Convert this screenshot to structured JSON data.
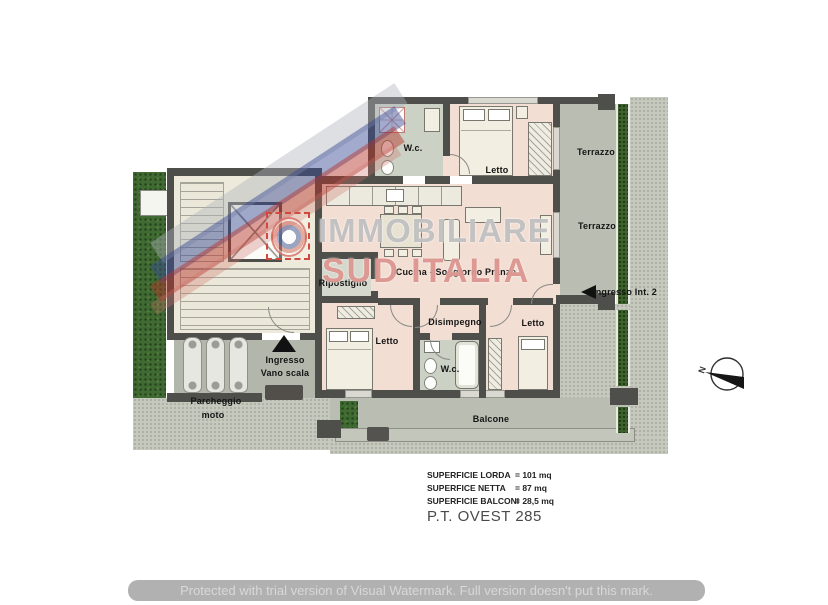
{
  "plan": {
    "rooms": {
      "wc_top": "W.c.",
      "letto_top": "Letto",
      "terrazzo_upper": "Terrazzo",
      "terrazzo_lower": "Terrazzo",
      "cucina": "Cucina - Soggiorno Pranzo",
      "ripostiglio": "Ripostiglio",
      "disimpegno": "Disimpegno",
      "letto_left": "Letto",
      "letto_right": "Letto",
      "wc_bottom": "W.c.",
      "balcone": "Balcone"
    },
    "labels": {
      "parcheggio_line1": "Parcheggio",
      "parcheggio_line2": "moto",
      "ingresso_vano_line1": "Ingresso",
      "ingresso_vano_line2": "Vano scala",
      "ingresso_int2": "Ingresso Int. 2"
    },
    "compass": "N"
  },
  "summary": {
    "lines": [
      {
        "label": "SUPERFICIE LORDA",
        "value": "= 101  mq"
      },
      {
        "label": "SUPERFICE NETTA",
        "value": "= 87  mq"
      },
      {
        "label": "SUPERFICIE BALCONI",
        "value": "= 28,5 mq"
      }
    ],
    "title": "P.T. OVEST 285"
  },
  "watermark": {
    "brand_line1": "IMMOBILIARE",
    "brand_line2": "SUD ITALIA",
    "footer": "Protected with trial version of Visual Watermark. Full version doesn't put this mark.",
    "colors": {
      "blue": "#3a4a94",
      "red": "#b63228",
      "gray": "#afb2b9"
    }
  }
}
